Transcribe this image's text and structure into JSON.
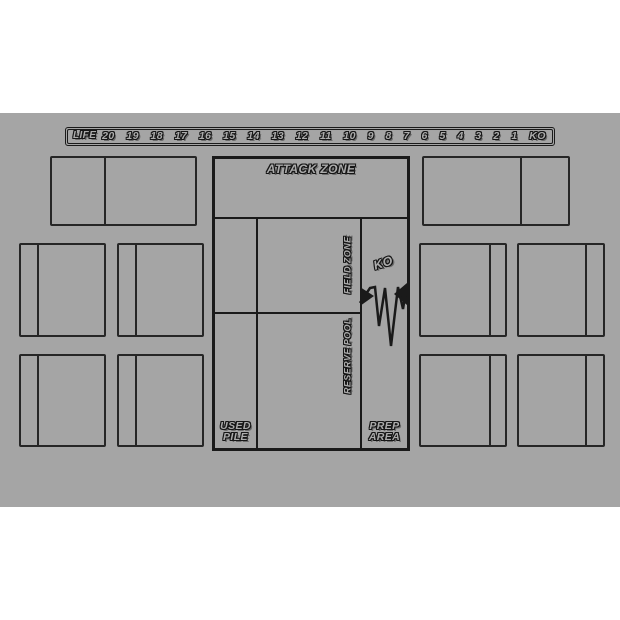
{
  "colors": {
    "background": "#ffffff",
    "mat": "#a5a5a5",
    "line": "#1a1a1a",
    "text_fill": "#ababab"
  },
  "life_track": {
    "label": "LIFE",
    "values": [
      "20",
      "19",
      "18",
      "17",
      "16",
      "15",
      "14",
      "13",
      "12",
      "11",
      "10",
      "9",
      "8",
      "7",
      "6",
      "5",
      "4",
      "3",
      "2",
      "1",
      "KO"
    ]
  },
  "zones": {
    "attack_zone": "ATTACK ZONE",
    "field_zone": "FIELD ZONE",
    "reserve_pool": "RESERVE POOL",
    "ko": "KO",
    "used_pile": "USED PILE",
    "prep_area": "PREP AREA"
  }
}
